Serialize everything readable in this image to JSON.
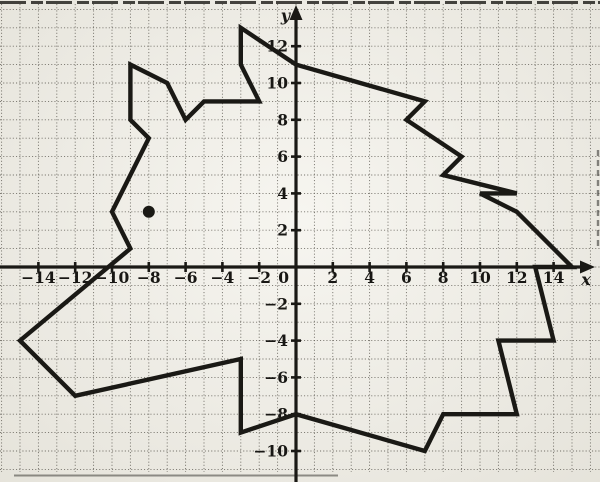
{
  "figure": {
    "paper_color": "#f2f0e8",
    "ink_color": "#1a1915",
    "grid_color": "#55524a"
  },
  "chart_data": {
    "type": "line",
    "title": "Horse-head outline plotted on a coordinate grid",
    "axes": {
      "x_label": "x",
      "y_label": "y",
      "x_range": [
        -16,
        16
      ],
      "y_range": [
        -11,
        14
      ],
      "grid": true,
      "grid_step": 1,
      "tick_step": 2,
      "x_ticks": [
        {
          "value": -14,
          "label": "−14"
        },
        {
          "value": -12,
          "label": "−12"
        },
        {
          "value": -10,
          "label": "−10"
        },
        {
          "value": -8,
          "label": "−8"
        },
        {
          "value": -6,
          "label": "−6"
        },
        {
          "value": -4,
          "label": "−4"
        },
        {
          "value": -2,
          "label": "−2"
        },
        {
          "value": 0,
          "label": "0"
        },
        {
          "value": 2,
          "label": "2"
        },
        {
          "value": 4,
          "label": "4"
        },
        {
          "value": 6,
          "label": "6"
        },
        {
          "value": 8,
          "label": "8"
        },
        {
          "value": 10,
          "label": "10"
        },
        {
          "value": 12,
          "label": "12"
        },
        {
          "value": 14,
          "label": "14"
        }
      ],
      "y_ticks": [
        {
          "value": 12,
          "label": "12"
        },
        {
          "value": 10,
          "label": "10"
        },
        {
          "value": 8,
          "label": "8"
        },
        {
          "value": 6,
          "label": "6"
        },
        {
          "value": 4,
          "label": "4"
        },
        {
          "value": 2,
          "label": "2"
        },
        {
          "value": -2,
          "label": "−2"
        },
        {
          "value": -4,
          "label": "−4"
        },
        {
          "value": -6,
          "label": "−6"
        },
        {
          "value": -8,
          "label": "−8"
        },
        {
          "value": -10,
          "label": "−10"
        }
      ]
    },
    "series": [
      {
        "name": "horse-head-outline",
        "closed": true,
        "stroke_width_px": 4.4,
        "points": [
          [
            -3,
            13
          ],
          [
            0,
            11
          ],
          [
            7,
            9
          ],
          [
            6,
            8
          ],
          [
            9,
            6
          ],
          [
            8,
            5
          ],
          [
            12,
            4
          ],
          [
            10,
            4
          ],
          [
            12,
            3
          ],
          [
            15,
            0
          ],
          [
            13,
            0
          ],
          [
            14,
            -4
          ],
          [
            11,
            -4
          ],
          [
            12,
            -8
          ],
          [
            8,
            -8
          ],
          [
            7,
            -10
          ],
          [
            0,
            -8
          ],
          [
            -3,
            -9
          ],
          [
            -3,
            -5
          ],
          [
            -12,
            -7
          ],
          [
            -15,
            -4
          ],
          [
            -9,
            1
          ],
          [
            -10,
            3
          ],
          [
            -8,
            7
          ],
          [
            -9,
            8
          ],
          [
            -9,
            11
          ],
          [
            -7,
            10
          ],
          [
            -6,
            8
          ],
          [
            -5,
            9
          ],
          [
            -2,
            9
          ],
          [
            -3,
            11
          ]
        ]
      }
    ],
    "markers": [
      {
        "name": "eye-dot",
        "x": -8,
        "y": 3,
        "radius_px": 6
      }
    ],
    "layout": {
      "canvas_px": [
        600,
        482
      ],
      "origin_px": [
        296,
        267
      ],
      "unit_px": 18.4,
      "grid_top_px": 4,
      "grid_bottom_px": 472
    }
  }
}
